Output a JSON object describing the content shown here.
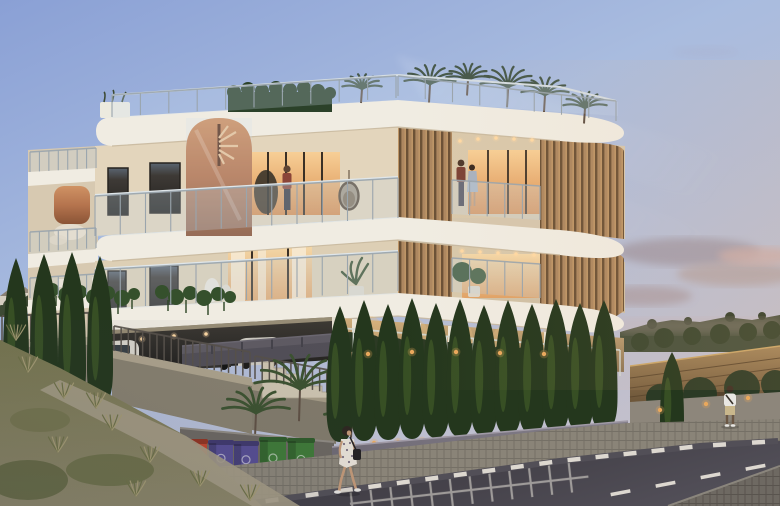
{
  "scene": {
    "type": "architectural-dusk-render",
    "subject": "modern three-storey apartment building on a corner plot at dusk",
    "elements": [
      "rooftop palm garden",
      "copper spiral staircase",
      "timber louver screens",
      "glass balustrades",
      "cypress hedge row",
      "street with road markings",
      "recycling bins",
      "pedestrians",
      "covered parking with cars"
    ]
  },
  "palette": {
    "sky_top": "#8aa0d5",
    "sky_mid": "#a9bcdf",
    "sky_low": "#c6c0c9",
    "cloud_grey": "#9e95a2",
    "cloud_pink": "#c9a8a4",
    "hill": "#46503c",
    "cream": "#e3d5bc",
    "cream_shade": "#d6c7ae",
    "cream_dark": "#c9b99e",
    "slab": "#f0ece2",
    "glass": "#c6d6e4",
    "copper_hi": "#cf9264",
    "copper_lo": "#8a5436",
    "wood": "#ad8760",
    "wood_gap": "#6b5136",
    "glow": "#f7cf96",
    "glow_deep": "#d98f52",
    "hedge": "#2b4129",
    "cypress": "#24371d",
    "cypress_rim": "#55742f",
    "palm_roof": "#46584a",
    "palm_ground": "#3c5230",
    "wall_grey": "#8f8678",
    "wall_cap": "#b4aa96",
    "wall_violet": "#7b7681",
    "stone": "#c9ad7c",
    "stone_deep": "#8a7354",
    "couch": "#57545c",
    "asphalt": "#46434b",
    "asphalt_deep": "#36343b",
    "sidewalk": "#8a8478",
    "cobble": "#6e6962",
    "marking": "#ddd8d0",
    "bin_red": "#c0452e",
    "bin_purple": "#564d92",
    "bin_green": "#3f7a38",
    "uplight": "#e9a85c",
    "skin": "#c49a78",
    "hair_dark": "#2e2620",
    "post": "#9aa5ad",
    "fence_post": "#57514a",
    "fence_wood": "#96794f",
    "fence_wood_deep": "#6b5438"
  },
  "figures": {
    "balcony_man": {
      "label": "man standing on upper front balcony"
    },
    "balcony_couple": {
      "label": "couple on upper right balcony"
    },
    "walking_woman": {
      "label": "woman in floral dress walking on sidewalk with shoulder bag"
    },
    "standing_man": {
      "label": "man in white t-shirt standing by wooden fence"
    }
  },
  "vehicles": {
    "van": "white van in carport",
    "suv_dark": "dark SUV",
    "suv_white": "white SUV"
  },
  "cypress_left": [
    [
      16,
      258,
      404,
      26
    ],
    [
      44,
      254,
      406,
      28
    ],
    [
      72,
      252,
      408,
      28
    ],
    [
      100,
      256,
      406,
      26
    ]
  ],
  "cypress_row": [
    [
      340,
      306,
      442,
      27
    ],
    [
      364,
      300,
      441,
      27
    ],
    [
      388,
      304,
      440,
      27
    ],
    [
      412,
      298,
      439,
      27
    ],
    [
      436,
      303,
      438,
      27
    ],
    [
      460,
      299,
      437,
      27
    ],
    [
      484,
      305,
      436,
      27
    ],
    [
      508,
      300,
      435,
      27
    ],
    [
      532,
      304,
      434,
      27
    ],
    [
      556,
      299,
      432,
      27
    ],
    [
      580,
      303,
      431,
      27
    ],
    [
      604,
      300,
      430,
      27
    ],
    [
      672,
      352,
      446,
      24
    ]
  ],
  "roof_palms": [
    [
      362,
      98,
      20
    ],
    [
      430,
      96,
      26
    ],
    [
      468,
      90,
      22
    ],
    [
      508,
      100,
      28
    ],
    [
      545,
      106,
      24
    ],
    [
      585,
      118,
      22
    ]
  ],
  "ground_palms": [
    [
      300,
      412,
      46
    ],
    [
      256,
      430,
      34
    ],
    [
      352,
      432,
      28
    ]
  ],
  "post_rows": [
    {
      "x1": 112,
      "y1": 95,
      "x2": 396,
      "y2": 76,
      "h": 22,
      "gap": 26
    },
    {
      "x1": 398,
      "y1": 76,
      "x2": 616,
      "y2": 101,
      "h": 20,
      "gap": 26
    },
    {
      "x1": 95,
      "y1": 196,
      "x2": 398,
      "y2": 178,
      "h": 40,
      "gap": 24
    },
    {
      "x1": 452,
      "y1": 180,
      "x2": 540,
      "y2": 186,
      "h": 34,
      "gap": 15
    },
    {
      "x1": 95,
      "y1": 270,
      "x2": 398,
      "y2": 252,
      "h": 39,
      "gap": 24
    },
    {
      "x1": 452,
      "y1": 258,
      "x2": 540,
      "y2": 264,
      "h": 34,
      "gap": 15
    },
    {
      "x1": 340,
      "y1": 328,
      "x2": 620,
      "y2": 350,
      "h": 26,
      "gap": 13,
      "color": "#d3d8d2",
      "w": 1.4
    },
    {
      "x1": 30,
      "y1": 152,
      "x2": 96,
      "y2": 148,
      "h": 20,
      "gap": 9
    },
    {
      "x1": 30,
      "y1": 232,
      "x2": 96,
      "y2": 228,
      "h": 20,
      "gap": 9
    },
    {
      "x1": 30,
      "y1": 278,
      "x2": 96,
      "y2": 274,
      "h": 20,
      "gap": 9
    }
  ],
  "fence_rows": [
    {
      "x1": 2,
      "y1": 316,
      "x2": 110,
      "y2": 312,
      "h": 27,
      "gap": 7
    },
    {
      "x1": 114,
      "y1": 326,
      "x2": 250,
      "y2": 352,
      "h": 25,
      "gap": 7
    },
    {
      "x1": 255,
      "y1": 356,
      "x2": 334,
      "y2": 371,
      "h": 23,
      "gap": 7
    }
  ],
  "light_dots": [
    [
      460,
      141
    ],
    [
      478,
      139
    ],
    [
      496,
      138
    ],
    [
      514,
      139
    ],
    [
      532,
      140
    ],
    [
      462,
      251
    ],
    [
      480,
      252
    ],
    [
      498,
      253
    ],
    [
      516,
      254
    ],
    [
      534,
      255
    ],
    [
      142,
      339
    ],
    [
      174,
      336
    ],
    [
      206,
      334
    ]
  ],
  "uplights": [
    [
      350,
      444
    ],
    [
      374,
      443
    ],
    [
      398,
      442
    ],
    [
      422,
      441
    ],
    [
      446,
      440
    ],
    [
      470,
      439
    ],
    [
      494,
      438
    ],
    [
      518,
      437
    ],
    [
      542,
      436
    ],
    [
      566,
      434
    ],
    [
      590,
      433
    ],
    [
      614,
      432
    ],
    [
      660,
      410
    ],
    [
      706,
      404
    ],
    [
      748,
      398
    ],
    [
      368,
      354
    ],
    [
      412,
      352
    ],
    [
      456,
      352
    ],
    [
      500,
      353
    ],
    [
      544,
      354
    ]
  ],
  "curb_line": [
    [
      252,
      503
    ],
    [
      332,
      492
    ],
    [
      560,
      461
    ],
    [
      700,
      446
    ],
    [
      778,
      441
    ]
  ],
  "center_line": [
    [
      598,
      497
    ],
    [
      778,
      463
    ]
  ],
  "bins": [
    {
      "x": 186,
      "y": 442,
      "w": 21,
      "h": 30,
      "color": "bin_red"
    },
    {
      "x": 209,
      "y": 443,
      "w": 24,
      "h": 34,
      "color": "bin_purple"
    },
    {
      "x": 234,
      "y": 444,
      "w": 24,
      "h": 35,
      "color": "bin_purple"
    },
    {
      "x": 260,
      "y": 440,
      "w": 26,
      "h": 40,
      "color": "bin_green"
    },
    {
      "x": 288,
      "y": 441,
      "w": 26,
      "h": 41,
      "color": "bin_green"
    }
  ],
  "tufts": [
    [
      28,
      372
    ],
    [
      64,
      398
    ],
    [
      112,
      430
    ],
    [
      58,
      452
    ],
    [
      150,
      462
    ],
    [
      200,
      486
    ],
    [
      16,
      340
    ],
    [
      96,
      408
    ],
    [
      250,
      500
    ],
    [
      136,
      496
    ]
  ]
}
